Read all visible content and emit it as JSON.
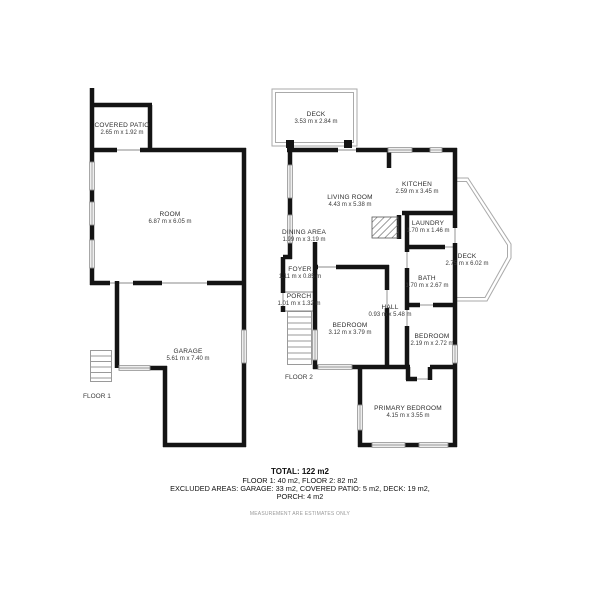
{
  "floor1": {
    "label": "FLOOR 1",
    "rooms": {
      "covered_patio": {
        "name": "COVERED PATIO",
        "dims": "2.65 m x 1.92 m"
      },
      "room": {
        "name": "ROOM",
        "dims": "6.87 m x 6.05 m"
      },
      "garage": {
        "name": "GARAGE",
        "dims": "5.61 m x 7.40 m"
      }
    }
  },
  "floor2": {
    "label": "FLOOR 2",
    "rooms": {
      "deck_top": {
        "name": "DECK",
        "dims": "3.53 m x 2.84 m"
      },
      "living_room": {
        "name": "LIVING ROOM",
        "dims": "4.43 m x 5.38 m"
      },
      "kitchen": {
        "name": "KITCHEN",
        "dims": "2.59 m x 3.45 m"
      },
      "dining_area": {
        "name": "DINING AREA",
        "dims": "1.99 m x 3.19 m"
      },
      "laundry": {
        "name": "LAUNDRY",
        "dims": "1.70 m x 1.46 m"
      },
      "deck_right": {
        "name": "DECK",
        "dims": "2.75 m x 6.02 m"
      },
      "foyer": {
        "name": "FOYER",
        "dims": "1.11 m x 0.85 m"
      },
      "porch": {
        "name": "PORCH",
        "dims": "1.01 m x 1.32 m"
      },
      "bath": {
        "name": "BATH",
        "dims": "1.70 m x 2.67 m"
      },
      "hall": {
        "name": "HALL",
        "dims": "0.93 m x 5.48 m"
      },
      "bedroom_1": {
        "name": "BEDROOM",
        "dims": "3.12 m x 3.79 m"
      },
      "bedroom_2": {
        "name": "BEDROOM",
        "dims": "2.19 m x 2.72 m"
      },
      "primary_bedroom": {
        "name": "PRIMARY BEDROOM",
        "dims": "4.15 m x 3.55 m"
      }
    }
  },
  "summary": {
    "total": "TOTAL: 122 m2",
    "floors": "FLOOR 1: 40 m2, FLOOR 2: 82 m2",
    "excluded_line1": "EXCLUDED AREAS: GARAGE: 33 m2, COVERED PATIO: 5 m2, DECK: 19 m2,",
    "excluded_line2": "PORCH: 4 m2",
    "disclaimer": "MEASUREMENT ARE ESTIMATES ONLY"
  },
  "colors": {
    "wall": "#141414",
    "window_line": "#8a8a8a",
    "deck_line": "#aaaaaa",
    "text": "#2e2e2e"
  }
}
